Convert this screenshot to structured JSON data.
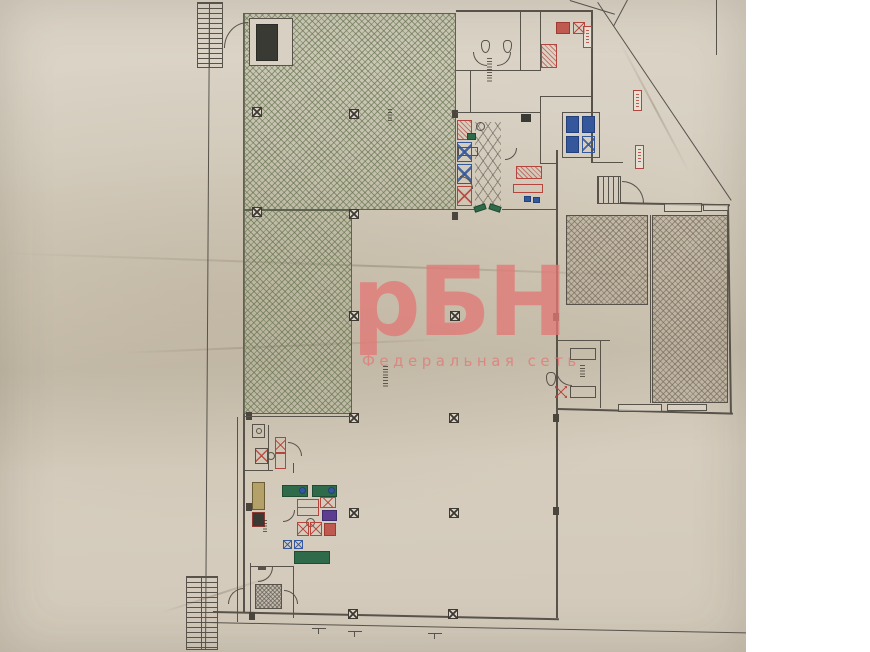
{
  "watermark": {
    "title": "рБН",
    "subtitle": "Федеральная сеть",
    "color": "#e27876"
  },
  "paper": {
    "base_color": "#d6cec0",
    "shadow_color": "#c6bdac",
    "ink_color": "#57524a"
  },
  "palette": {
    "sales_hall_hatch": "#62704a",
    "storage_hatch": "#6e6252",
    "equipment_red": "#b5443c",
    "equipment_blue": "#35589c",
    "equipment_green": "#2f6b4a",
    "equipment_purple": "#5c3d8f",
    "equipment_tan": "#b3a169"
  },
  "icons": {
    "column-marker": "square with X",
    "door-arc": "quarter-circle swing",
    "stairs": "parallel treads",
    "ladder-ramp": "striped strip",
    "red-tag": "vertical red label (illegible)",
    "illegible-label": "tiny rotated note (unreadable)"
  }
}
